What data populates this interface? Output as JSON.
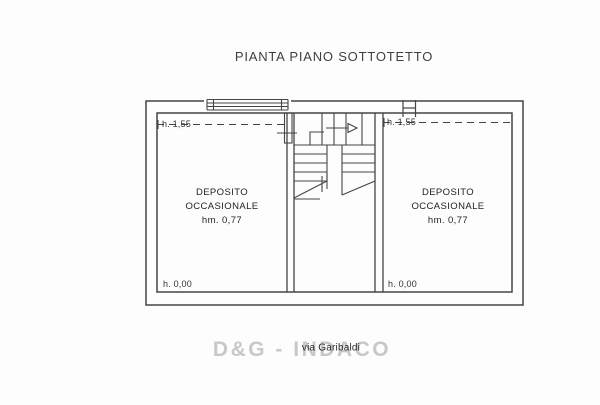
{
  "title": "PIANTA PIANO SOTTOTETTO",
  "rooms": [
    {
      "name_line1": "DEPOSITO",
      "name_line2": "OCCASIONALE",
      "mid_height_label": "hm. 0,77",
      "ceiling_height_label": "h. 1,55",
      "floor_height_label": "h. 0,00"
    },
    {
      "name_line1": "DEPOSITO",
      "name_line2": "OCCASIONALE",
      "mid_height_label": "hm. 0,77",
      "ceiling_height_label": "h. 1,55",
      "floor_height_label": "h. 0,00"
    }
  ],
  "watermark": "D&G - INDACO",
  "street_label": "via Garibaldi",
  "colors": {
    "line": "#454545",
    "watermark": "#c7c9c7",
    "background": "#fdfdfd",
    "text": "#2e2e2e"
  }
}
